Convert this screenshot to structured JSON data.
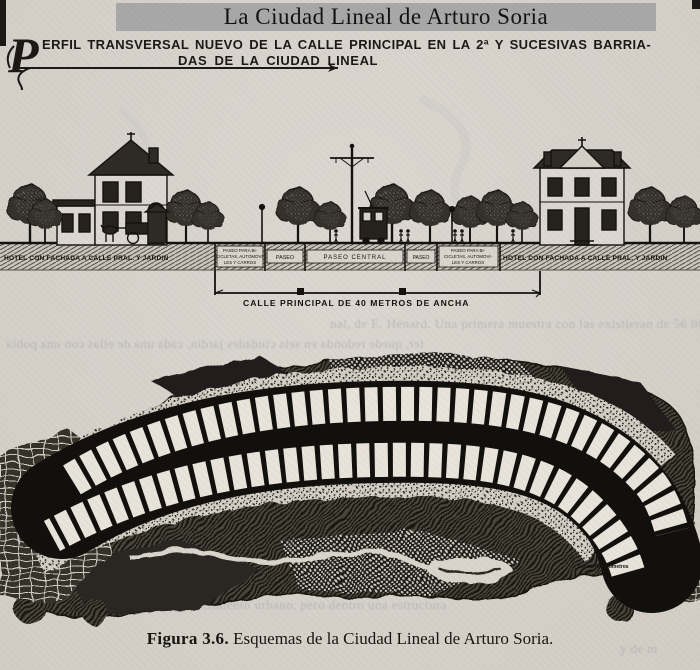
{
  "page": {
    "title": "La Ciudad Lineal de Arturo Soria",
    "paper_color": "#d6d2cb",
    "ink_color": "#1b1916",
    "title_highlight_color": "#a8a8a8"
  },
  "heading": {
    "initial": "P",
    "line1": "ERFIL TRANSVERSAL NUEVO DE LA CALLE PRINCIPAL EN LA 2ª Y SUCESIVAS BARRIA-",
    "line2": "DAS  DE LA  CIUDAD LINEAL"
  },
  "cross_section": {
    "left_hotel_label": "HOTEL CON FACHADA A CALLE PRAL. Y JARDIN",
    "right_hotel_label": "HOTEL CON FACHADA A CALLE PRAL. Y JARDIN",
    "lanes": [
      {
        "lines": [
          "PASEO PARA BI-",
          "CICLETAS, AUTOMOVI-",
          "LES Y CARROS"
        ]
      },
      {
        "lines": [
          "PASEO"
        ]
      },
      {
        "lines": [
          "PASEO CENTRAL"
        ]
      },
      {
        "lines": [
          "PASEO"
        ]
      },
      {
        "lines": [
          "PASEO PARA BI-",
          "CICLETAS, AUTOMOVI-",
          "LES Y CARROS"
        ]
      }
    ],
    "dimension_label": "CALLE PRINCIPAL DE 40 METROS DE ANCHA"
  },
  "map": {
    "scale_label": "Escala de Kilómetros"
  },
  "caption": {
    "figure_number": "Figura 3.6.",
    "text": "Esquemas de la Ciudad Lineal de Arturo Soria."
  },
  "ghost_text": {
    "top1": "nal, de E. Hénard. Una primera muestra con las existieran de 56 000 habitan",
    "top2": "ter, quede redonda en seis ciudades jardín, cada una de ellas con una pobla",
    "bottom1": "de la estructura; y se mueve en la línea de que es",
    "bottom2": "necesario encauzar el crecimiento urbano, pero dentro una estructura",
    "bottom3": "y de m"
  }
}
